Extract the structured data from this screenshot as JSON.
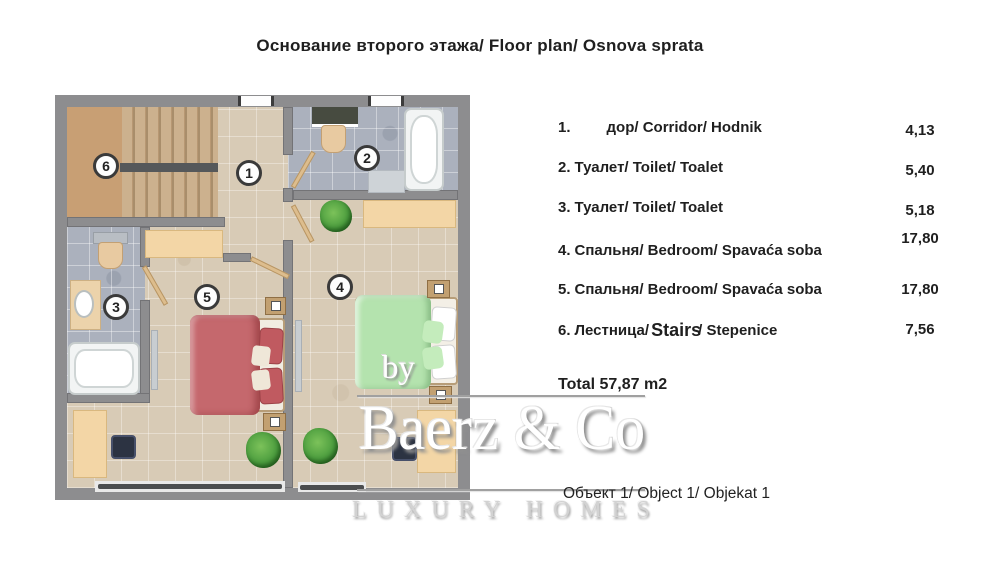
{
  "title": "Основание второго этажа/ Floor plan/ Osnova sprata",
  "legend": {
    "rows": [
      {
        "num": "1.",
        "text": "дор/ Corridor/ Hodnik",
        "value": "4,13"
      },
      {
        "num": "2.",
        "text": "Туалет/ Toilet/ Toalet",
        "value": "5,40"
      },
      {
        "num": "3.",
        "text": "Туалет/ Toilet/ Toalet",
        "value": "5,18"
      },
      {
        "num": "4.",
        "text": "Спальня/ Bedroom/ Spavaća soba",
        "value": "17,80"
      },
      {
        "num": "5.",
        "text": "Спальня/ Bedroom/ Spavaća soba",
        "value": "17,80"
      },
      {
        "num": "6.",
        "text": "Лестница/",
        "text_mid": "Stairs",
        "text_end": "/ Stepenice",
        "value": "7,56"
      }
    ],
    "total": "Total 57,87 m2"
  },
  "object_caption": "Объект 1/ Object 1/ Objekat 1",
  "watermark": {
    "by": "by",
    "brand": "Baerz & Co",
    "tagline": "LUXURY HOMES"
  },
  "plan": {
    "badges": [
      "1",
      "2",
      "3",
      "4",
      "5",
      "6"
    ],
    "rooms": [
      {
        "badge": "1",
        "name": "Corridor"
      },
      {
        "badge": "2",
        "name": "Toilet"
      },
      {
        "badge": "3",
        "name": "Toilet"
      },
      {
        "badge": "4",
        "name": "Bedroom"
      },
      {
        "badge": "5",
        "name": "Bedroom"
      },
      {
        "badge": "6",
        "name": "Stairs"
      }
    ]
  },
  "colors": {
    "wall": "#8d8d8f",
    "floor_beige": "#d8cbb6",
    "floor_gray": "#abb1bd",
    "stairs_tan": "#c7a37b",
    "furniture_tan": "#f3d6a6",
    "bed_red": "#c5686d",
    "bed_green": "#b4e3ae",
    "plant_green": "#4d9e3f",
    "text": "#1f1f1f",
    "watermark_gray": "#d2d2d2"
  }
}
